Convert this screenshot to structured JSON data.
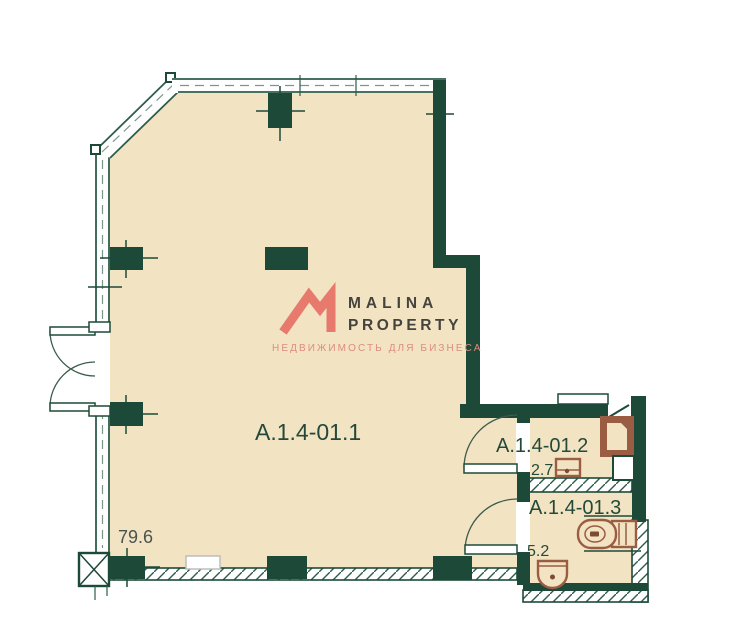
{
  "plan": {
    "logo": {
      "name_line1": "MALINA",
      "name_line2": "PROPERTY",
      "tagline": "НЕДВИЖИМОСТЬ ДЛЯ БИЗНЕСА"
    },
    "rooms": [
      {
        "id": "A.1.4-01.1",
        "area": "79.6"
      },
      {
        "id": "A.1.4-01.2",
        "area": "2.7"
      },
      {
        "id": "A.1.4-01.3",
        "area": "5.2"
      }
    ],
    "colors": {
      "wall_green": "#1d4a38",
      "window_green": "#2e5d4b",
      "floor_beige": "#f2e3c2",
      "fixture_brown": "#9a5c42",
      "fixture_brown_dark": "#7d4a36",
      "logo_red": "#e87a6d",
      "logo_text": "#45433e",
      "logo_tagline": "#dd8c80",
      "label_green": "#24493a",
      "number_gray": "#4a5350"
    }
  }
}
